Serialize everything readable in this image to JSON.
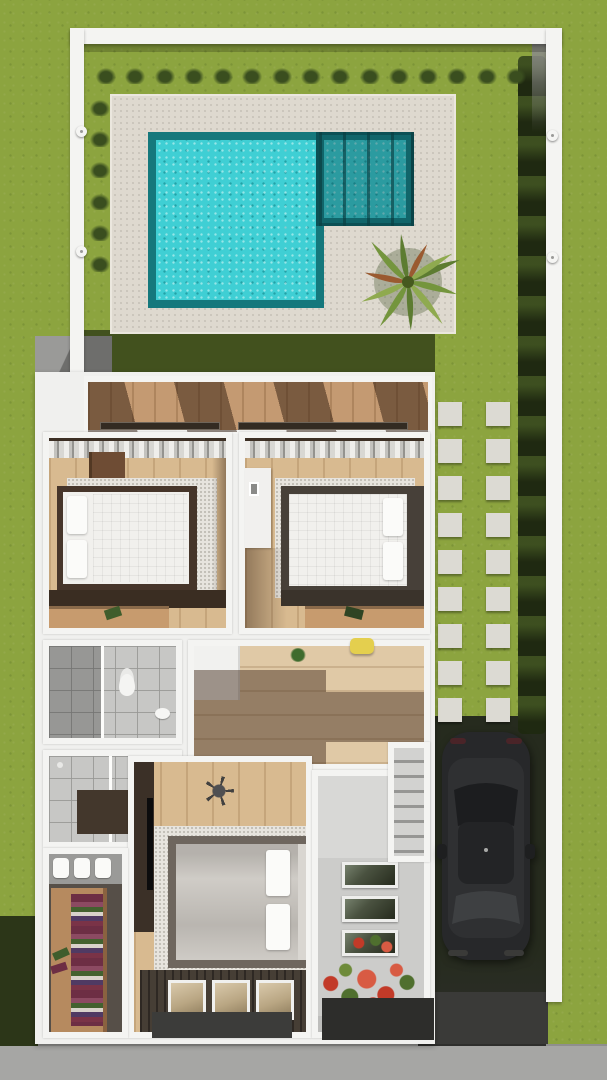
{
  "scene": {
    "kind": "3d-architectural-floor-plan-render",
    "view": "top-down",
    "floor": "upper floor with pool garden, bedrooms and driveway"
  },
  "palette": {
    "lawn": "#8CA43F",
    "lawnDark": "#42511E",
    "hedge": "#2E3C19",
    "shrub": "#3A4E1F",
    "deck": "#DED9CF",
    "poolRim": "#15787C",
    "poolWater": "#3FCFD4",
    "wall": "#F4F4F2",
    "wallShade": "#8A8A88",
    "stone": "#DCDAD3",
    "pavement": "#262B1E",
    "apron": "#3A3A38",
    "sidewalk": "#A6A6A4",
    "houseBase": "#F0F0EE",
    "terraceWood": "#C49A72",
    "woodFloor": "#D8BA90",
    "woodHall": "#E0C9A6",
    "rug": "#E7E4DE",
    "furnDark": "#46352A",
    "ledgeDark": "#3A2D22",
    "consoleWood": "#C79B6E",
    "mattress": "#F1F0ED",
    "pillow": "#FBFBF9",
    "blanket": "#C9C5BF",
    "platformGray": "#6E665E",
    "tile": "#C7C7C5",
    "bathMat": "#43372C",
    "stair": "#D2D2D0",
    "stairDark": "#969694",
    "entryFloor": "#CCCCCA",
    "glassA": "#76816D",
    "glassB": "#262B1D",
    "deckDark": "#463E35",
    "closetWood": "#B68A5F",
    "closetFloor": "#564F48",
    "clothesPlum": "#6D2E44",
    "tv": "#0C0C0D",
    "car": "#27282A",
    "carRoof": "#232426",
    "carGlass": "#3E4042",
    "flowerRed": "#C23A28",
    "flowerRed2": "#D85B43",
    "flowerGreen": "#4F6F2E",
    "flowerGreen2": "#6E8B3A",
    "stoolYellow": "#E4CF4E",
    "plant": "#3F6B2D",
    "lampWhite": "#F5F5F3",
    "palmA": "#5D7C31",
    "palmB": "#74953D",
    "palmC": "#8FAA4F",
    "palmRust": "#9A5A30"
  },
  "counts": {
    "topShrubs": 15,
    "leftShrubs": 6,
    "stoneRows": 9,
    "stoneColumns": 2,
    "wallLamps": 4,
    "towels": 3,
    "stairGlassPanels": 3,
    "bedroomGlassPanels": 3
  },
  "rooms": {
    "terrace": "terrace / balcony",
    "bedroom1": "bedroom 1",
    "bedroom2": "bedroom 2",
    "bathroom1": "bathroom with toilet",
    "bathroom2": "shower room",
    "hallway": "hallway",
    "stairs": "staircase",
    "entry": "stair landing / entry",
    "master": "master bedroom",
    "closet": "walk-in closet"
  },
  "outdoor": {
    "pool": "L-shaped turquoise pool with pergola-covered spa corner",
    "deck": "stone pool deck",
    "palm": "palm tree",
    "hedge": "hedge along right boundary wall",
    "path": "stepping-stone path to driveway",
    "vehicle": "dark SUV parked on driveway",
    "sidewalk": "street sidewalk",
    "flowers": "red flowering shrubs at entry"
  }
}
